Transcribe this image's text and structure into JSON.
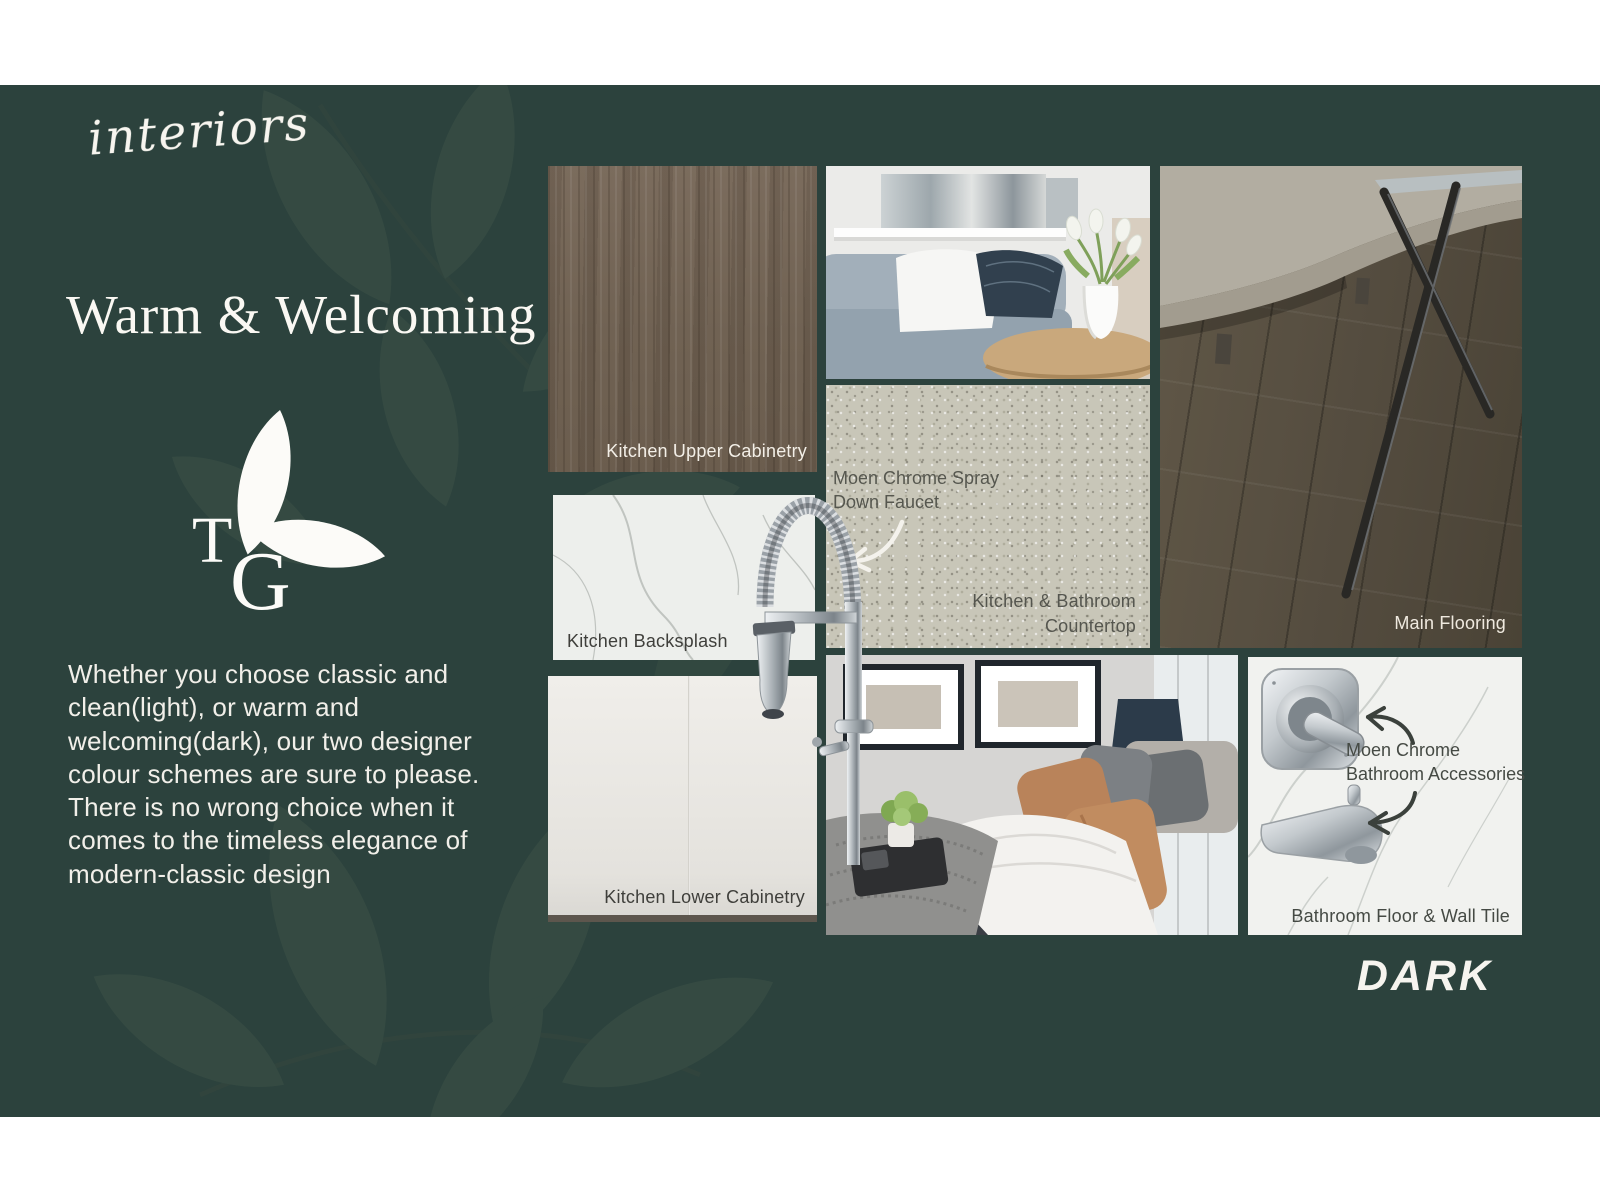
{
  "brand": {
    "script_name": "interiors"
  },
  "heading": {
    "title": "Warm & Welcoming"
  },
  "logo": {
    "letter_t": "T",
    "letter_g": "G"
  },
  "intro": {
    "paragraph": "Whether you choose classic and clean(light), or warm and welcoming(dark), our two designer colour schemes are sure to please. There is no wrong choice when it comes to the timeless elegance of modern-classic design"
  },
  "scheme": {
    "label": "DARK"
  },
  "labels": {
    "upper_cabinetry": "Kitchen Upper Cabinetry",
    "backsplash": "Kitchen Backsplash",
    "countertop_line1": "Kitchen & Bathroom",
    "countertop_line2": "Countertop",
    "lower_cabinetry": "Kitchen Lower Cabinetry",
    "flooring": "Main Flooring",
    "bathroom_tile": "Bathroom Floor & Wall Tile"
  },
  "annotations": {
    "faucet_line1": "Moen Chrome Spray",
    "faucet_line2": "Down Faucet",
    "accessories_line1": "Moen Chrome",
    "accessories_line2": "Bathroom Accessories"
  },
  "colors": {
    "background": "#2c423d",
    "letterbox_bar": "#ffffff",
    "heading_text": "#faf8f3",
    "label_light": "#f3efe7",
    "label_dark": "#3f3f3b",
    "annotation_dark": "#454a44",
    "arrow_light": "#f4f2ec",
    "arrow_dark": "#3b413c",
    "leaf_watermark": "#3e5348"
  }
}
